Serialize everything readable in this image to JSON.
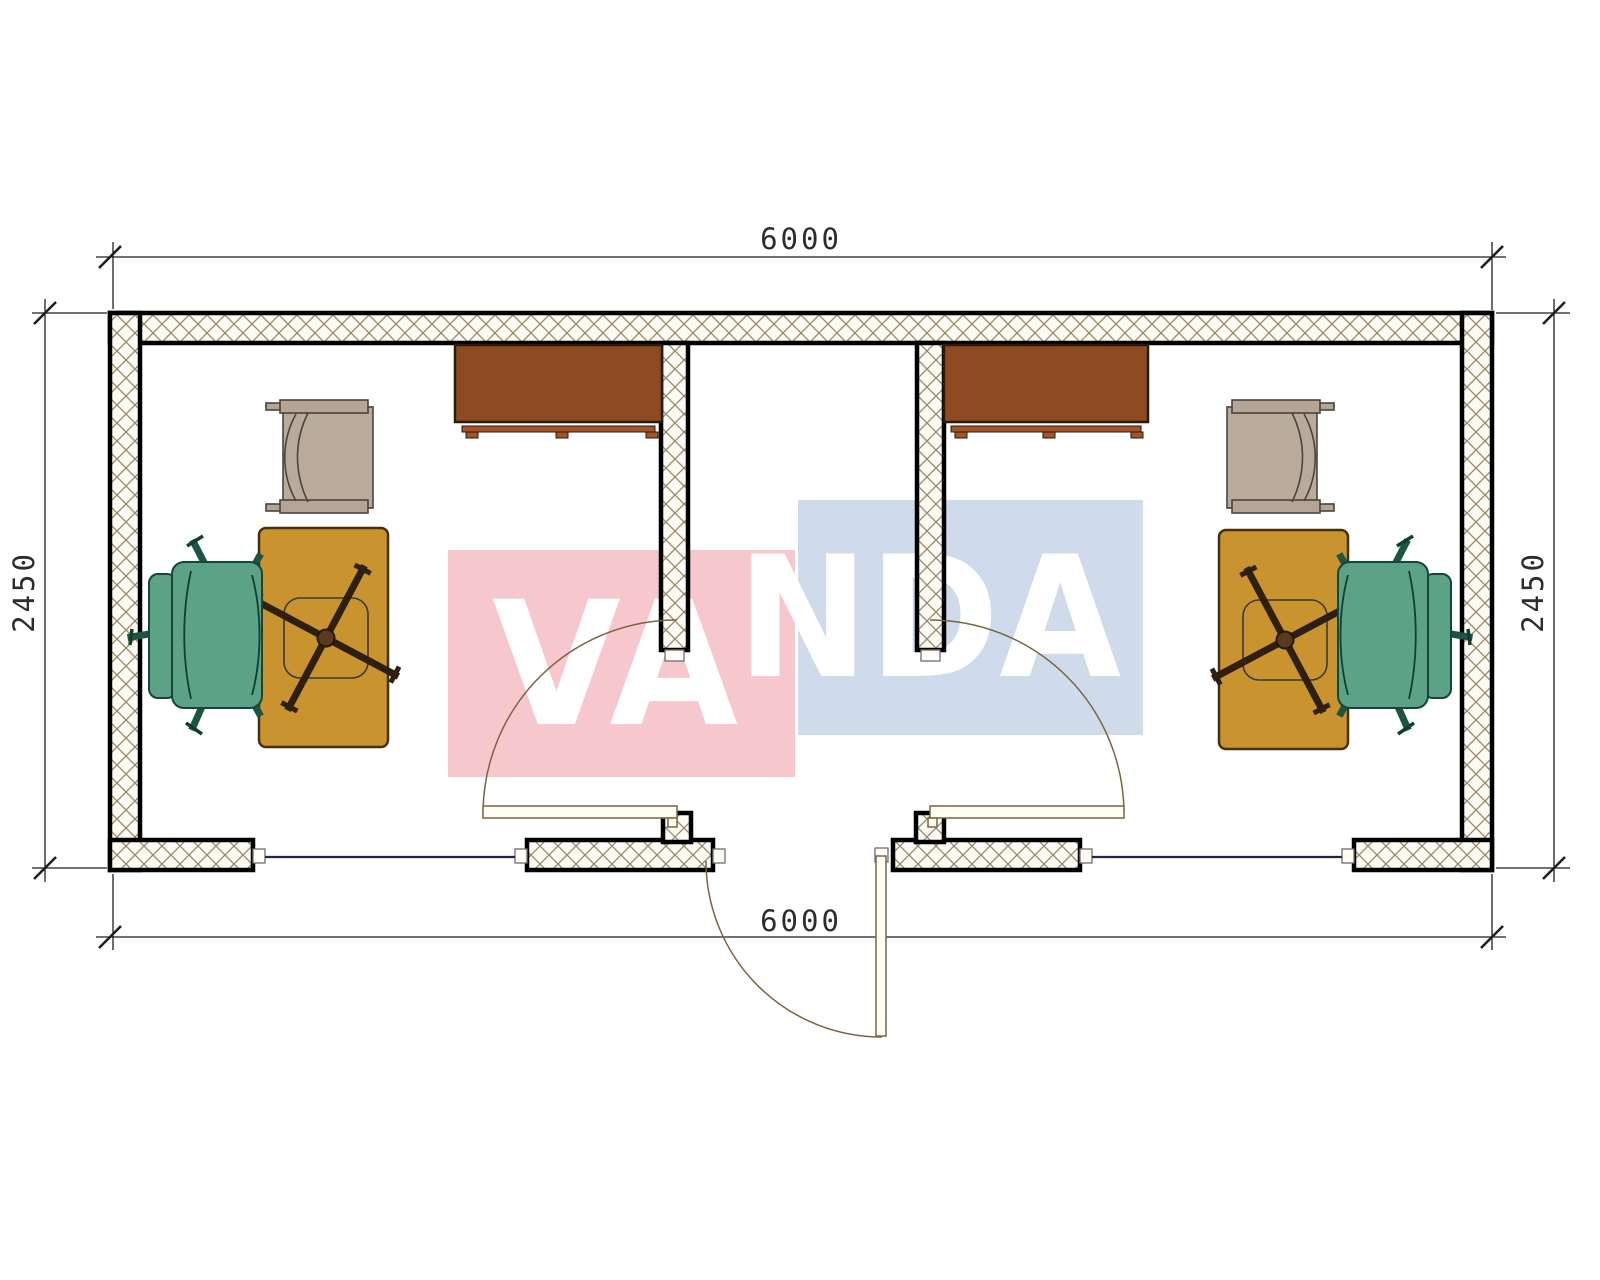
{
  "drawing": {
    "kind": "floor-plan"
  },
  "dimensions": {
    "top": "6000",
    "bottom": "6000",
    "left": "2450",
    "right": "2450"
  },
  "watermark": {
    "text": "VANDA",
    "part_left": "VA",
    "part_right": "NDA",
    "red_box_color": "#f7c7ce",
    "blue_box_color": "#cfdbeb",
    "letter_color": "#ffffff"
  },
  "colors": {
    "paper": "#ffffff",
    "wall_line": "#000000",
    "wall_fill": "#fcfaf2",
    "wall_hatch": "#99896a",
    "jamb_fill": "#fffdf6",
    "window_line": "#23234f",
    "door_line": "#7a6440",
    "dimension_line": "#1f1f1f",
    "cabinet": "#8e4a21",
    "cabinet_trim": "#a2572a",
    "desk": "#c9932f",
    "desk_edge": "#46300e",
    "chair_base": "#2e1f10",
    "office_chair": "#5ba287",
    "office_chair_outline": "#15463a",
    "armchair": "#b4a597",
    "armchair_seat": "#b9ab9c"
  },
  "furniture": {
    "left_room": [
      "cabinet",
      "armchair",
      "desk",
      "desk-chair-base",
      "office-chair"
    ],
    "right_room": [
      "cabinet",
      "armchair",
      "desk",
      "desk-chair-base",
      "office-chair"
    ]
  }
}
